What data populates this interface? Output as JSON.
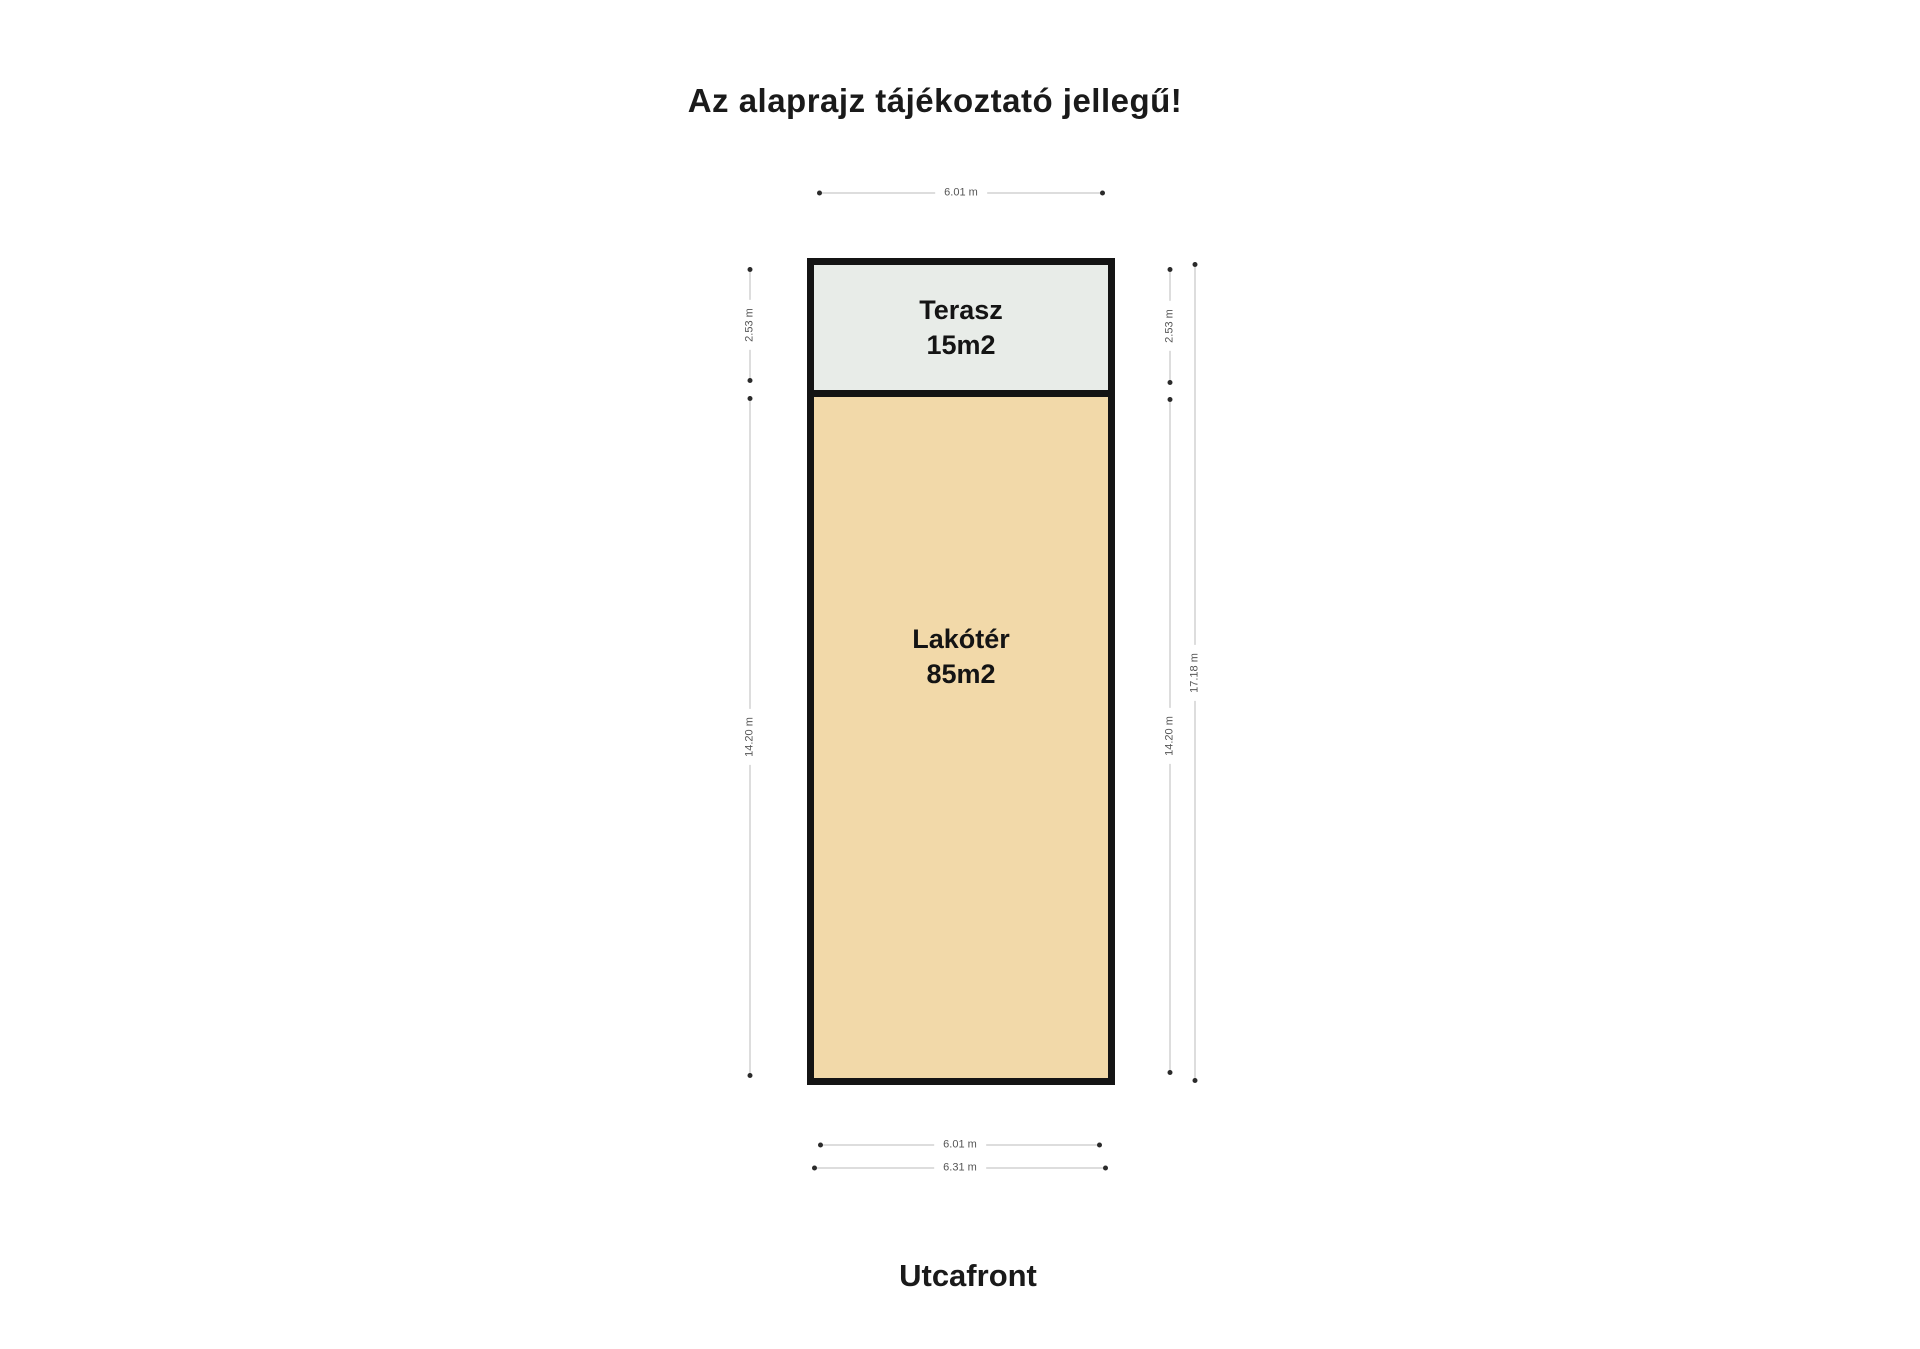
{
  "title": "Az alaprajz tájékoztató jellegű!",
  "street_label": "Utcafront",
  "rooms": {
    "terasz": {
      "name": "Terasz",
      "area": "15m2"
    },
    "lakoter": {
      "name": "Lakótér",
      "area": "85m2"
    }
  },
  "dimensions": {
    "top_width": "6.01 m",
    "bottom_width": "6.01 m",
    "bottom_total_width": "6.31 m",
    "left_terasz_height": "2.53 m",
    "left_lakoter_height": "14.20 m",
    "right_terasz_height": "2.53 m",
    "right_lakoter_height": "14.20 m",
    "right_total_height": "17.18 m"
  },
  "colors": {
    "terasz_fill": "#e8ece8",
    "lakoter_fill": "#f2d9a9",
    "wall": "#141414",
    "dimension_line": "#bbbbbb",
    "dimension_text": "#555555",
    "title_text": "#1a1a1a",
    "background": "#ffffff"
  }
}
